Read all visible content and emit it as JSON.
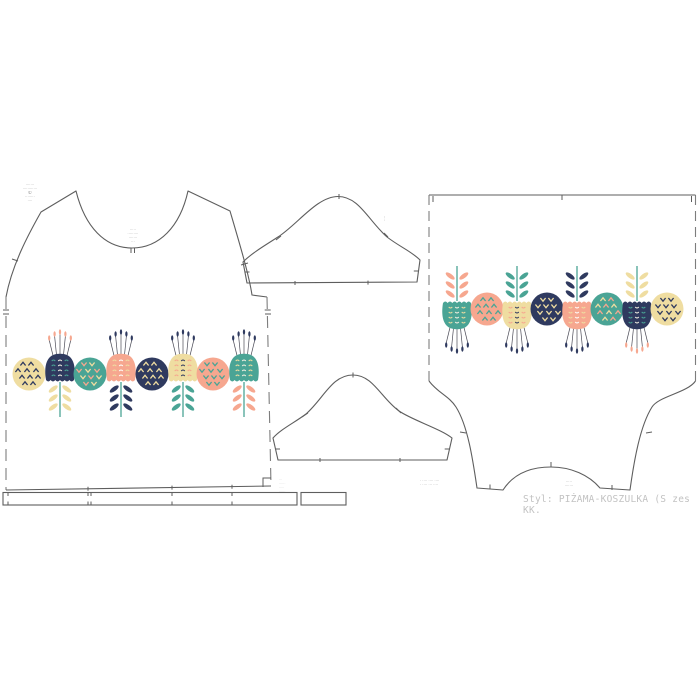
{
  "colors": {
    "background": "#ffffff",
    "outline": "#5e5e5e",
    "dashline": "#7d7d7d",
    "annotation": "#8f8f8f",
    "footer_text": "#c2c2c2",
    "palette": {
      "navy": "#2f3a5f",
      "teal": "#4aa495",
      "peach": "#f6a78f",
      "yellow": "#efdda1",
      "cream": "#f6f1e4",
      "white": "#ffffff",
      "stalk": "#4a4a55"
    }
  },
  "annotations": {
    "front_corner": {
      "lines": [
        "·······",
        "············",
        "©",
        "········",
        "····"
      ]
    },
    "front_neck": {
      "lines": [
        "·····",
        "·········",
        "·······",
        "···"
      ]
    },
    "front_hem": {
      "lines": [
        "···",
        "······",
        "·····",
        "······"
      ]
    },
    "back_left": {
      "lines": [
        "· ···· ···· ····",
        "· ···· ··· ····"
      ]
    },
    "back_center": {
      "lines": [
        "·····",
        "·······"
      ]
    },
    "sleeve_label": "····",
    "footer_style": "Styl: PIŻAMA-KOSZULKA (S zes KK."
  },
  "front_row": {
    "x": [
      29,
      60,
      90,
      121,
      152,
      183,
      213,
      244
    ],
    "baseline_y": 418,
    "rotate": false
  },
  "back_row": {
    "x": [
      457,
      487,
      517,
      547,
      577,
      607,
      637,
      667
    ],
    "baseline_y": 265,
    "rotate": true
  },
  "front_motifs": [
    {
      "type": "circle",
      "fill": "yellow",
      "chevrons": [
        "navy"
      ],
      "dir": "up"
    },
    {
      "type": "tulip",
      "head": "navy",
      "details": [
        "teal",
        "cream"
      ],
      "leaves": "yellow",
      "stamens": "peach"
    },
    {
      "type": "circle",
      "fill": "teal",
      "chevrons": [
        "peach",
        "yellow"
      ],
      "dir": "down"
    },
    {
      "type": "tulip",
      "head": "peach",
      "details": [
        "yellow",
        "white"
      ],
      "leaves": "navy",
      "stamens": "navy"
    },
    {
      "type": "circle",
      "fill": "navy",
      "chevrons": [
        "yellow"
      ],
      "dir": "up"
    },
    {
      "type": "tulip",
      "head": "yellow",
      "details": [
        "peach",
        "navy"
      ],
      "leaves": "teal",
      "stamens": "navy"
    },
    {
      "type": "circle",
      "fill": "peach",
      "chevrons": [
        "teal"
      ],
      "dir": "down"
    },
    {
      "type": "tulip",
      "head": "teal",
      "details": [
        "yellow",
        "cream"
      ],
      "leaves": "peach",
      "stamens": "navy"
    }
  ],
  "back_motifs": [
    {
      "type": "tulip",
      "head": "teal",
      "details": [
        "yellow",
        "cream"
      ],
      "leaves": "peach",
      "stamens": "navy"
    },
    {
      "type": "circle",
      "fill": "peach",
      "chevrons": [
        "teal"
      ],
      "dir": "down"
    },
    {
      "type": "tulip",
      "head": "yellow",
      "details": [
        "peach",
        "navy"
      ],
      "leaves": "teal",
      "stamens": "navy"
    },
    {
      "type": "circle",
      "fill": "navy",
      "chevrons": [
        "yellow"
      ],
      "dir": "up"
    },
    {
      "type": "tulip",
      "head": "peach",
      "details": [
        "yellow",
        "white"
      ],
      "leaves": "navy",
      "stamens": "navy"
    },
    {
      "type": "circle",
      "fill": "teal",
      "chevrons": [
        "peach",
        "yellow"
      ],
      "dir": "down"
    },
    {
      "type": "tulip",
      "head": "navy",
      "details": [
        "teal",
        "cream"
      ],
      "leaves": "yellow",
      "stamens": "peach"
    },
    {
      "type": "circle",
      "fill": "yellow",
      "chevrons": [
        "navy"
      ],
      "dir": "up"
    }
  ]
}
